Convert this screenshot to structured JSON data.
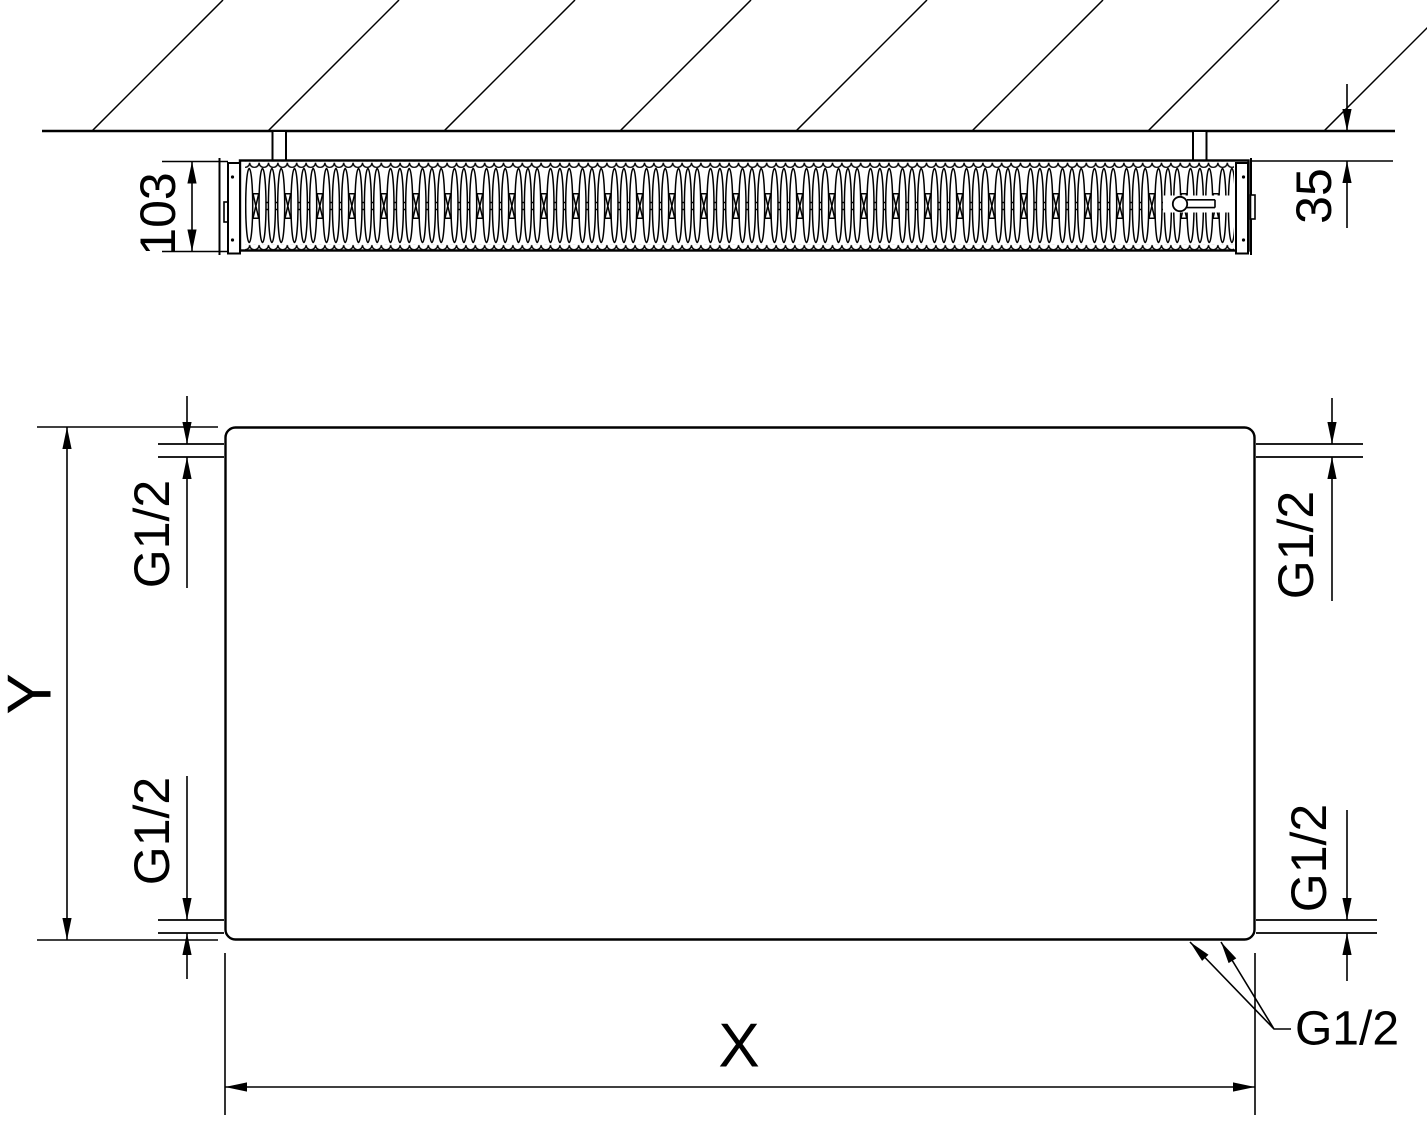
{
  "meta": {
    "background_color": "#ffffff",
    "line_color": "#000000"
  },
  "top_view": {
    "depth_label": "103",
    "wall_clearance_label": "35"
  },
  "front_view": {
    "height_label": "Y",
    "width_label": "X",
    "ports": {
      "top_left": "G1/2",
      "top_right": "G1/2",
      "bottom_left": "G1/2",
      "bottom_right": "G1/2",
      "bottom_pair": "G1/2"
    }
  }
}
